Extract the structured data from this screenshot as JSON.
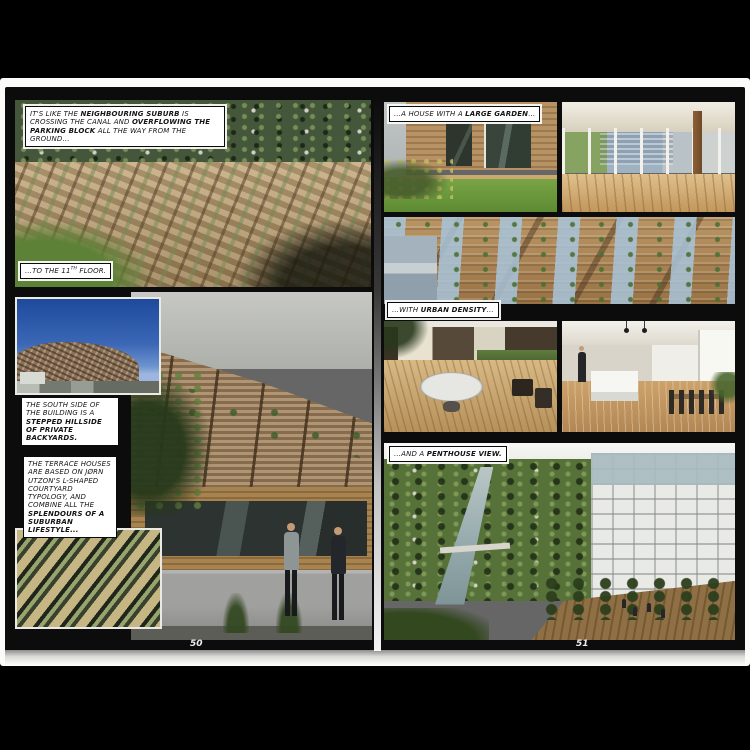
{
  "book": {
    "title_context": "comic-style architecture book spread",
    "left_page": {
      "page_number": "50"
    },
    "right_page": {
      "page_number": "51"
    }
  },
  "colors": {
    "viewer_background": "#000000",
    "paper": "#fbfbf9",
    "printed_page": "#0c0c0c",
    "caption_background": "#ffffff",
    "caption_text": "#141414",
    "page_number_text": "#ececec"
  },
  "captions": {
    "overflow": {
      "segments": [
        {
          "t": "IT'S LIKE THE "
        },
        {
          "t": "NEIGHBOURING SUBURB",
          "b": true
        },
        {
          "t": " IS CROSSING THE CANAL AND "
        },
        {
          "t": "OVERFLOWING THE PARKING BLOCK",
          "b": true
        },
        {
          "t": " ALL THE WAY FROM THE GROUND..."
        }
      ]
    },
    "eleventh_floor": {
      "segments": [
        {
          "t": "...TO THE 11"
        },
        {
          "t": "TH",
          "sup": true
        },
        {
          "t": " FLOOR."
        }
      ]
    },
    "south_side": {
      "segments": [
        {
          "t": "THE SOUTH SIDE OF THE BUILDING IS A "
        },
        {
          "t": "STEPPED HILLSIDE OF PRIVATE BACKYARDS.",
          "b": true
        }
      ]
    },
    "terrace_houses": {
      "segments": [
        {
          "t": "THE TERRACE HOUSES ARE BASED ON JØRN UTZON'S L-SHAPED COURTYARD TYPOLOGY, AND COMBINE ALL THE "
        },
        {
          "t": "SPLENDOURS OF A SUBURBAN LIFESTYLE...",
          "b": true
        }
      ]
    },
    "large_garden": {
      "segments": [
        {
          "t": "...A HOUSE WITH A "
        },
        {
          "t": "LARGE GARDEN",
          "b": true
        },
        {
          "t": "..."
        }
      ]
    },
    "urban_density": {
      "segments": [
        {
          "t": "...WITH "
        },
        {
          "t": "URBAN DENSITY",
          "b": true
        },
        {
          "t": "..."
        }
      ]
    },
    "penthouse_view": {
      "segments": [
        {
          "t": "...AND A "
        },
        {
          "t": "PENTHOUSE VIEW.",
          "b": true
        }
      ]
    }
  },
  "photos": {
    "aerial_overflow": {
      "alt": "Aerial view of wooden terraced housing overflowing toward a green suburb"
    },
    "blue_sky_mountain": {
      "alt": "Terraced building mound against deep blue sky"
    },
    "stepped_hillside": {
      "alt": "Street view of stepped wooden hillside building with two men walking"
    },
    "terrace_model": {
      "alt": "Aerial rendering of dense L-shaped terrace house model with green roofs"
    },
    "house_garden": {
      "alt": "Private courtyard garden with lawn and glazed wooden house"
    },
    "covered_terrace": {
      "alt": "Covered roof terrace with wooden deck and sliding glass walls"
    },
    "facade_density": {
      "alt": "Dense stepped wooden facade with blue glass balustrades"
    },
    "deck_round_table": {
      "alt": "Roof deck with round white table and chairs"
    },
    "kitchen_interior": {
      "alt": "Penthouse interior with white kitchen island and dining table"
    },
    "penthouse_outlook": {
      "alt": "Penthouse view over canal, trees and white apartment building with rooftop gathering"
    }
  }
}
